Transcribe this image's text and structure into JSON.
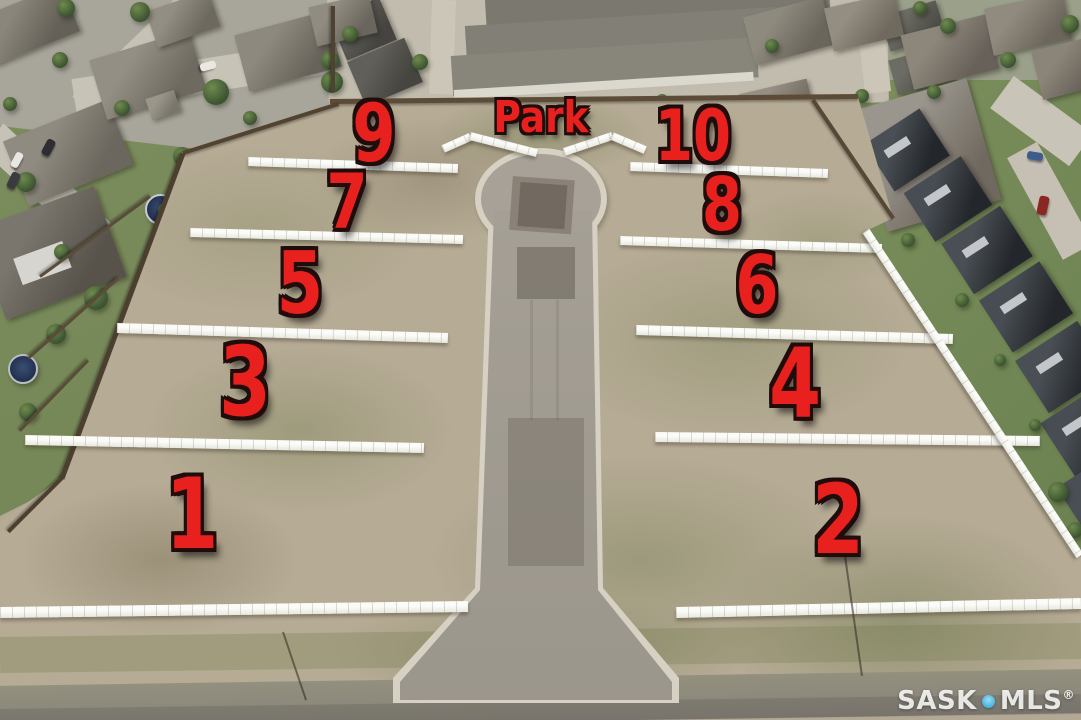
{
  "scene": {
    "description": "Aerial drone photo of a vacant-lot subdivision with a cul-de-sac road, white vinyl fences dividing ten lots, surrounded by houses and townhomes"
  },
  "annotations": {
    "park_label": "Park",
    "lot_numbers": [
      "1",
      "2",
      "3",
      "4",
      "5",
      "6",
      "7",
      "8",
      "9",
      "10"
    ],
    "annotation_color": "#e8211f",
    "annotation_outline": "#200c0a"
  },
  "watermark": {
    "prefix": "SASK",
    "suffix": "MLS",
    "registered": "®",
    "text_color": "#ffffff",
    "dot_color": "#3fb1dd"
  },
  "palette": {
    "dirt": "#b6ab95",
    "road_asphalt": "#a5a096",
    "bottom_street": "#8e8a80",
    "curb_concrete": "#d7d1c3",
    "fence_white": "#f4f4f0",
    "fence_wood": "#5c4b37",
    "lawn_green": "#74895a",
    "dark_roofs": "#23272b"
  }
}
